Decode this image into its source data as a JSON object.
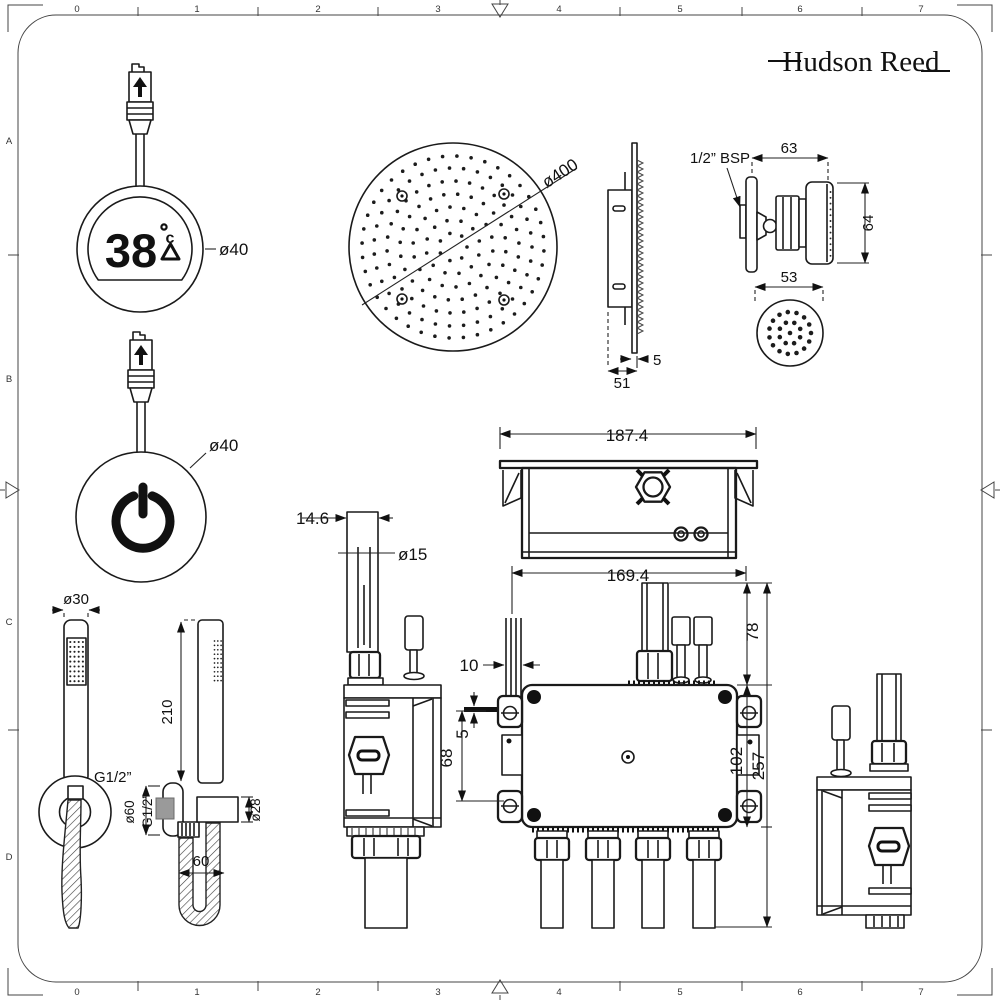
{
  "brand": "Hudson Reed",
  "rulers": {
    "top": [
      "0",
      "1",
      "2",
      "3",
      "4",
      "5",
      "6",
      "7"
    ],
    "bottom": [
      "0",
      "1",
      "2",
      "3",
      "4",
      "5",
      "6",
      "7"
    ],
    "left": [
      "A",
      "B",
      "C",
      "D"
    ]
  },
  "thermostat": {
    "value": "38",
    "unit": "c",
    "diameter": "ø40"
  },
  "power": {
    "diameter": "ø40"
  },
  "shower_head": {
    "diameter": "ø400",
    "plate_thickness": "5",
    "depth": "51"
  },
  "body_jet": {
    "thread": "1/2” BSP",
    "width": "63",
    "height": "64",
    "face": "53"
  },
  "recess_box": {
    "width": "187.4"
  },
  "valve": {
    "span": "169.4",
    "inlet_height": "78",
    "body_height": "102",
    "total_height": "257",
    "pipe_offset": "10",
    "pin_gap": "5",
    "port_height": "68",
    "pipe_width": "14.6",
    "pipe_dia": "ø15"
  },
  "handset": {
    "head_dia": "ø30",
    "thread_front": "G1/2”",
    "length": "210",
    "flange_dia": "ø60",
    "thread_side": "G1/2”",
    "bracket_dia": "ø28",
    "hose_gap": "60"
  }
}
